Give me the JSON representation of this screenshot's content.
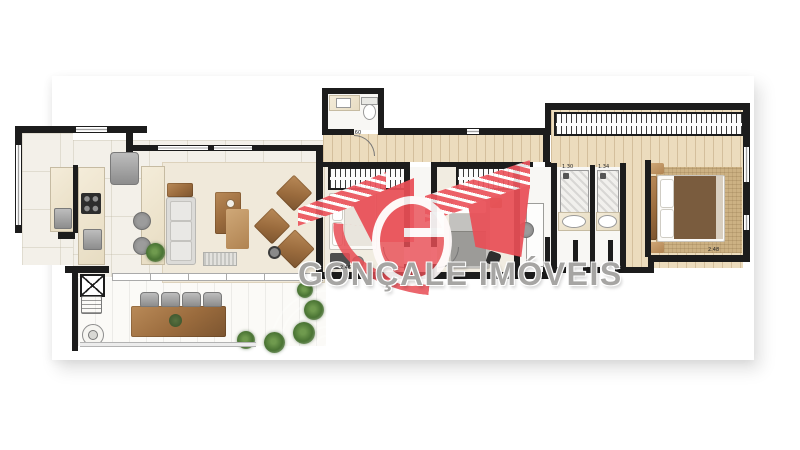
{
  "watermark": {
    "brand_text": "GONÇALE IMÓVEIS",
    "logo_letter": "G",
    "logo_color": "#e94f57",
    "text_color": "#a6a5a3"
  },
  "dimensions": {
    "social_bathroom": "1.60",
    "bath_left": "1.30",
    "bath_right": "1.34",
    "bedroom": "2.46",
    "master_bedroom": "2.48"
  },
  "colors": {
    "walls": "#1c1c1c",
    "wood_floor": "#ecdcbd",
    "tile_floor": "#f3f0e9",
    "furniture_wood": "#9a6b3d",
    "logo_red": "#e94f57"
  }
}
